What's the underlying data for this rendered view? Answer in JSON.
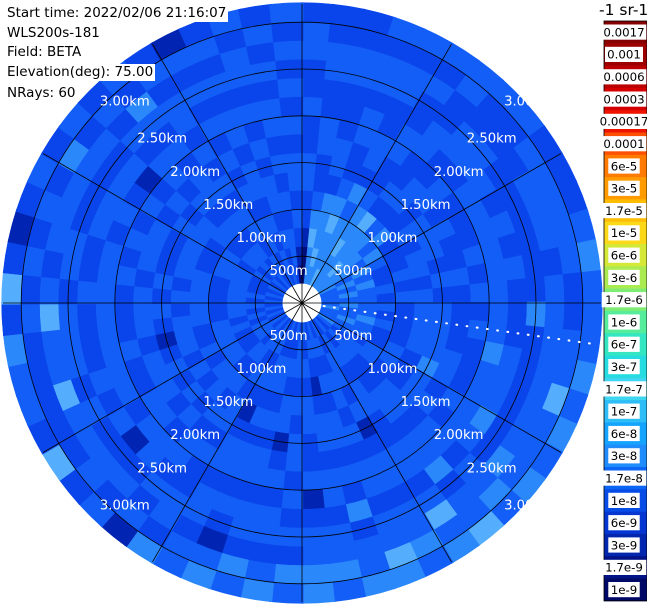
{
  "header": {
    "lines": [
      "Start time: 2022/02/06 21:16:07",
      "WLS200s-181",
      "Field: BETA",
      "Elevation(deg): 75.00",
      "NRays: 60"
    ]
  },
  "colorbar": {
    "title": "-1 sr-1",
    "ticks": [
      {
        "label": "0.0017",
        "color": "#870000"
      },
      {
        "label": "0.001",
        "color": "#9e0000"
      },
      {
        "label": "0.0006",
        "color": "#bb0000"
      },
      {
        "label": "0.0003",
        "color": "#d40000"
      },
      {
        "label": "0.00017",
        "color": "#ee1500"
      },
      {
        "label": "0.0001",
        "color": "#ff4f00"
      },
      {
        "label": "6e-5",
        "color": "#ff7a00"
      },
      {
        "label": "3e-5",
        "color": "#ff9b00"
      },
      {
        "label": "1.7e-5",
        "color": "#ffbc00"
      },
      {
        "label": "1e-5",
        "color": "#fcd918"
      },
      {
        "label": "6e-6",
        "color": "#d6e837"
      },
      {
        "label": "3e-6",
        "color": "#abeb52"
      },
      {
        "label": "1.7e-6",
        "color": "#7fec74"
      },
      {
        "label": "1e-6",
        "color": "#55ec9b"
      },
      {
        "label": "6e-7",
        "color": "#35e6c2"
      },
      {
        "label": "3e-7",
        "color": "#25dce0"
      },
      {
        "label": "1.7e-7",
        "color": "#3fd6f2"
      },
      {
        "label": "1e-7",
        "color": "#2fbdf8"
      },
      {
        "label": "6e-8",
        "color": "#14a3fd"
      },
      {
        "label": "3e-8",
        "color": "#1e8cfb"
      },
      {
        "label": "1.7e-8",
        "color": "#0b66f5"
      },
      {
        "label": "1e-8",
        "color": "#084ce8"
      },
      {
        "label": "6e-9",
        "color": "#0536d2"
      },
      {
        "label": "3e-9",
        "color": "#0226ae"
      },
      {
        "label": "1.7e-9",
        "color": "#011387"
      },
      {
        "label": "1e-9",
        "color": "#000a66"
      }
    ]
  },
  "chart_data": {
    "type": "heatmap",
    "projection": "polar",
    "field": "BETA",
    "instrument": "WLS200s-181",
    "start_time": "2022/02/06 21:16:07",
    "elevation_deg": 75.0,
    "n_rays": 60,
    "n_gates": 15,
    "gate_length_m": 200,
    "blind_zone_m": 200,
    "r_axis_range_km": [
      0,
      3.2
    ],
    "range_rings_km": [
      0.5,
      1.0,
      1.5,
      2.0,
      2.5,
      3.0
    ],
    "ring_labels": [
      "500m",
      "1.00km",
      "1.50km",
      "2.00km",
      "2.50km",
      "3.00km"
    ],
    "ring_label_azimuths_deg": [
      45,
      135,
      225,
      315
    ],
    "azimuth_grid_step_deg": 30,
    "beam_indicator_azimuth_deg": 98,
    "palette_colors": {
      "a": "#000d7a",
      "d": "#0125b2",
      "m": "#0a45eb",
      "b": "#135ef6",
      "B": "#2b88fa",
      "L": "#55aefd"
    },
    "palette_values_sr-1": {
      "a": "1.7e-9",
      "d": "3e-9",
      "m": "7e-9",
      "b": "1.5e-8",
      "B": "3e-8",
      "L": "6e-8"
    },
    "rays": [
      "aadmmbbmmbmmbbm",
      "BBLBbmmbbmmbbmm",
      "BLBBBmbbmmmbbmm",
      "BBBLBbmmbbmbbmb",
      "LBBBbBmbbmmbbmb",
      "BBLBBbmmbbmmbmb",
      "BBBBLmbmmbbmmbb",
      "BLBBbmbbmmbbmmb",
      "BBBbBmmbbmbbmmb",
      "BBbBmbbmmbbmmbm",
      "BbBbmmbbmbmmbbm",
      "bBbmmbbmmbbmbbm",
      "bbBmbbmmbbmmbbb",
      "bBbbmmbbmbbmmbB",
      "bbbmbbmmbbmmbmb",
      "bBbbmbbmmbmBbmb",
      "Bbbmmbbmbbmmbbb",
      "bbBbmbbmmBbmbbB",
      "bBbmmbbbmbbmbLb",
      "bbbmbmBbmbbmbbB",
      "BbmbbmbmbbBmbbb",
      "bmbbmmbbmbbmBbB",
      "mbbmmbbmbbmbbBb",
      "bmbmmbbmbbBmbbL",
      "mbbmbbmmbbmbLbB",
      "bmbbmbdmbbmbbBb",
      "mbmbbmbmbbmbbLB",
      "bbmbmbbmbmBmbbB",
      "mbmdmbbmbbmbbBb",
      "bmbmbbmmbdmbbBB",
      "mbbmbmbbmbmbmBb",
      "bmbmbbdmbmbbmbB",
      "mmbbmbmbbmbbmBb",
      "bmbbmbmbbmbmdbB",
      "mbmbmdmbbmbbmbb",
      "bbmbmbbmbmmbbmB",
      "mbbmbmbmbbmbmbd",
      "bmbmbbmbmbbmbmb",
      "mbmbbmbmbbdmbbm",
      "bbmbmbmbbmbmbmL",
      "mbmbbmbbmbmbbmm",
      "bmbbmbmbmbbmLmb",
      "mbmbmbdmbbmbbmb",
      "bmbmbbmbmbmbbmB",
      "mbbmbmbbmbmbLbm",
      "bmbmbbmbmbbmbmL",
      "mbbmbmbmbbmbmbm",
      "bmbmbbmbmbmbbmd",
      "mmbbmbmbbmbmbbm",
      "bmbbmbmbmbbmbmb",
      "mbmbmbbmbmbmbBm",
      "bmbmbbmbmdbmbmb",
      "mbbmbmbmbbmbmbm",
      "bmbmbmbbmbmbBmb",
      "mbmbbmbmbmbbmbm",
      "bmbbmbmbmbmbmbd",
      "mbmbmbbmbbmbmbm",
      "bmbmbbmbmbmbbmb",
      "mbbmbmbmbbmbmbm",
      "admbmbbmbmbmbmb"
    ],
    "layout": {
      "center_px": [
        302,
        303
      ],
      "inner_radius_px": 19,
      "outer_radius_px": 300,
      "ring_spacing_px": 46.8,
      "colorbar": {
        "x": 604,
        "y": 21,
        "width": 43,
        "seg_height": 22.3,
        "label_x": 624
      }
    }
  }
}
